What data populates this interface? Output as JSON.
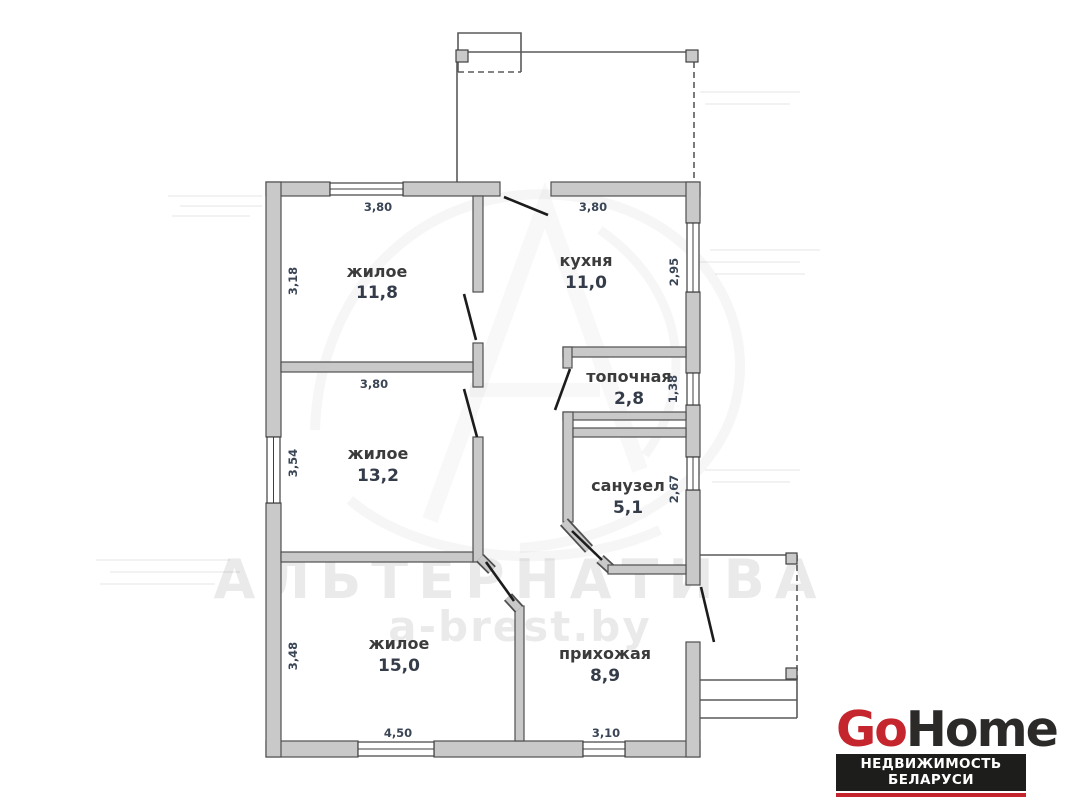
{
  "plan": {
    "rooms": {
      "living1": {
        "name": "жилое",
        "area": "11,8"
      },
      "kitchen": {
        "name": "кухня",
        "area": "11,0"
      },
      "boiler": {
        "name": "топочная",
        "area": "2,8"
      },
      "living2": {
        "name": "жилое",
        "area": "13,2"
      },
      "bathroom": {
        "name": "санузел",
        "area": "5,1"
      },
      "living3": {
        "name": "жилое",
        "area": "15,0"
      },
      "hallway": {
        "name": "прихожая",
        "area": "8,9"
      }
    },
    "dims": {
      "living1_top": "3,80",
      "living1_left": "3,18",
      "kitchen_top": "3,80",
      "kitchen_right": "2,95",
      "boiler_right": "1,38",
      "living2_top": "3,80",
      "living2_left": "3,54",
      "bathroom_right": "2,67",
      "living3_left": "3,48",
      "living3_bottom": "4,50",
      "hallway_bottom": "3,10"
    }
  },
  "watermark": {
    "agency": "АЛЬТЕРНАТИВА",
    "website": "a-brest.by"
  },
  "logo": {
    "brand_part1": "Go",
    "brand_part2": "Home",
    "tagline": "НЕДВИЖИМОСТЬ БЕЛАРУСИ"
  },
  "colors": {
    "wall_fill": "#c9c9c9",
    "wall_stroke": "#4f4f4f",
    "dim_text": "#3a4556",
    "room_text": "#3b3b3b",
    "logo_red": "#c5252c",
    "logo_dark": "#2b2a29"
  }
}
